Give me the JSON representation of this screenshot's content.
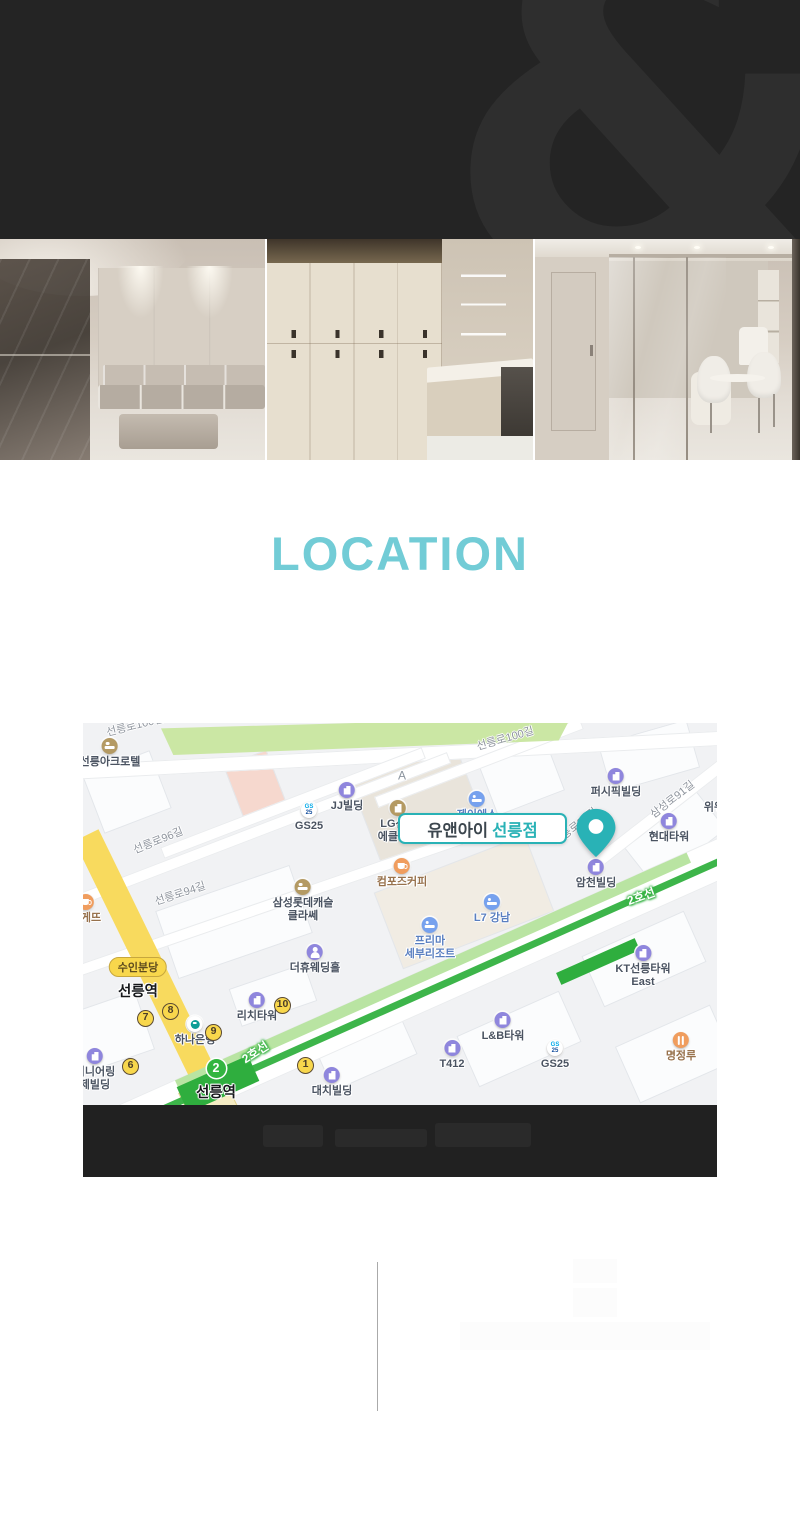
{
  "colors": {
    "header_dark": "#242424",
    "accent_teal": "#72ccd6",
    "pin_teal": "#29b2b6",
    "line2_green": "#3db54a",
    "suin_yellow": "#f8d74c"
  },
  "header": {
    "watermark": "&"
  },
  "section": {
    "title": "LOCATION"
  },
  "map": {
    "marker": {
      "name_regular": "유앤아이",
      "name_bold": "선릉점"
    },
    "roads": [
      {
        "text": "선릉로100길",
        "x": 52,
        "y": 2,
        "rot": -14
      },
      {
        "text": "선릉로100길",
        "x": 422,
        "y": 15,
        "rot": -16
      },
      {
        "text": "선릉로96길",
        "x": 75,
        "y": 117,
        "rot": -22
      },
      {
        "text": "선릉로94길",
        "x": 97,
        "y": 170,
        "rot": -18
      },
      {
        "text": "삼성로91길",
        "x": 589,
        "y": 76,
        "rot": -38
      },
      {
        "text": "선릉로92길",
        "x": 492,
        "y": 103,
        "rot": -38
      }
    ],
    "line_labels": [
      {
        "text": "2호선",
        "x": 172,
        "y": 329,
        "rot": -33
      },
      {
        "text": "2호선",
        "x": 558,
        "y": 173,
        "rot": -20
      }
    ],
    "pois": [
      {
        "icon": "hotel-brown",
        "lines": [
          "선릉아크로텔"
        ],
        "x": 27,
        "y": 24,
        "cls": ""
      },
      {
        "icon": "building",
        "lines": [
          "JJ빌딩"
        ],
        "x": 264,
        "y": 68,
        "cls": ""
      },
      {
        "icon": "gs25",
        "lines": [
          "GS25"
        ],
        "x": 226,
        "y": 88,
        "cls": ""
      },
      {
        "icon": "",
        "lines": [
          "A"
        ],
        "x": 319,
        "y": 53,
        "cls": "muted"
      },
      {
        "icon": "hotel",
        "lines": [
          "제이에스"
        ],
        "x": 394,
        "y": 77,
        "cls": "blue"
      },
      {
        "icon": "lg",
        "lines": [
          "LG선릉",
          "에클라트"
        ],
        "x": 315,
        "y": 86,
        "cls": ""
      },
      {
        "icon": "building",
        "lines": [
          "퍼시픽빌딩"
        ],
        "x": 533,
        "y": 54,
        "cls": ""
      },
      {
        "icon": "building",
        "lines": [
          "현대타워"
        ],
        "x": 586,
        "y": 99,
        "cls": ""
      },
      {
        "icon": "",
        "lines": [
          "위워"
        ],
        "x": 631,
        "y": 85,
        "cls": ""
      },
      {
        "icon": "building",
        "lines": [
          "암천빌딩"
        ],
        "x": 513,
        "y": 145,
        "cls": ""
      },
      {
        "icon": "coffee",
        "lines": [
          "컴포즈커피"
        ],
        "x": 319,
        "y": 144,
        "cls": "brown"
      },
      {
        "icon": "hotel",
        "lines": [
          "L7 강남"
        ],
        "x": 409,
        "y": 180,
        "cls": "blue"
      },
      {
        "icon": "hotel",
        "lines": [
          "프리마",
          "세부리조트"
        ],
        "x": 347,
        "y": 203,
        "cls": "blue"
      },
      {
        "icon": "hotel-brown",
        "lines": [
          "삼성롯데캐슬",
          "클라쎄"
        ],
        "x": 220,
        "y": 165,
        "cls": ""
      },
      {
        "icon": "wedding",
        "lines": [
          "더휴웨딩홀"
        ],
        "x": 232,
        "y": 230,
        "cls": ""
      },
      {
        "icon": "bakery",
        "lines": [
          "바게뜨"
        ],
        "x": 3,
        "y": 180,
        "cls": "brown"
      },
      {
        "icon": "building",
        "lines": [
          "리치타워"
        ],
        "x": 174,
        "y": 278,
        "cls": ""
      },
      {
        "icon": "bank",
        "lines": [
          "하나은행"
        ],
        "x": 112,
        "y": 302,
        "cls": ""
      },
      {
        "icon": "building",
        "lines": [
          "지니어링",
          "제빌딩"
        ],
        "x": 12,
        "y": 334,
        "cls": ""
      },
      {
        "icon": "building",
        "lines": [
          "대치빌딩"
        ],
        "x": 249,
        "y": 353,
        "cls": ""
      },
      {
        "icon": "building",
        "lines": [
          "T412"
        ],
        "x": 369,
        "y": 326,
        "cls": ""
      },
      {
        "icon": "building",
        "lines": [
          "L&B타워"
        ],
        "x": 420,
        "y": 298,
        "cls": ""
      },
      {
        "icon": "building",
        "lines": [
          "KT선릉타워",
          "East"
        ],
        "x": 560,
        "y": 231,
        "cls": ""
      },
      {
        "icon": "gs25",
        "lines": [
          "GS25"
        ],
        "x": 472,
        "y": 326,
        "cls": ""
      },
      {
        "icon": "restaurant",
        "lines": [
          "명정루"
        ],
        "x": 598,
        "y": 318,
        "cls": "brown"
      }
    ],
    "exits": [
      {
        "n": "7",
        "x": 63,
        "y": 296
      },
      {
        "n": "8",
        "x": 88,
        "y": 289
      },
      {
        "n": "9",
        "x": 131,
        "y": 310
      },
      {
        "n": "6",
        "x": 48,
        "y": 344
      },
      {
        "n": "10",
        "x": 200,
        "y": 283
      },
      {
        "n": "1",
        "x": 223,
        "y": 343
      }
    ],
    "stations": [
      {
        "badge": "수인분당",
        "label": "선릉역",
        "x": 55,
        "y": 244,
        "type": "suin"
      },
      {
        "badge": "2",
        "label": "선릉역",
        "x": 133,
        "y": 346,
        "type": "line2"
      }
    ]
  }
}
